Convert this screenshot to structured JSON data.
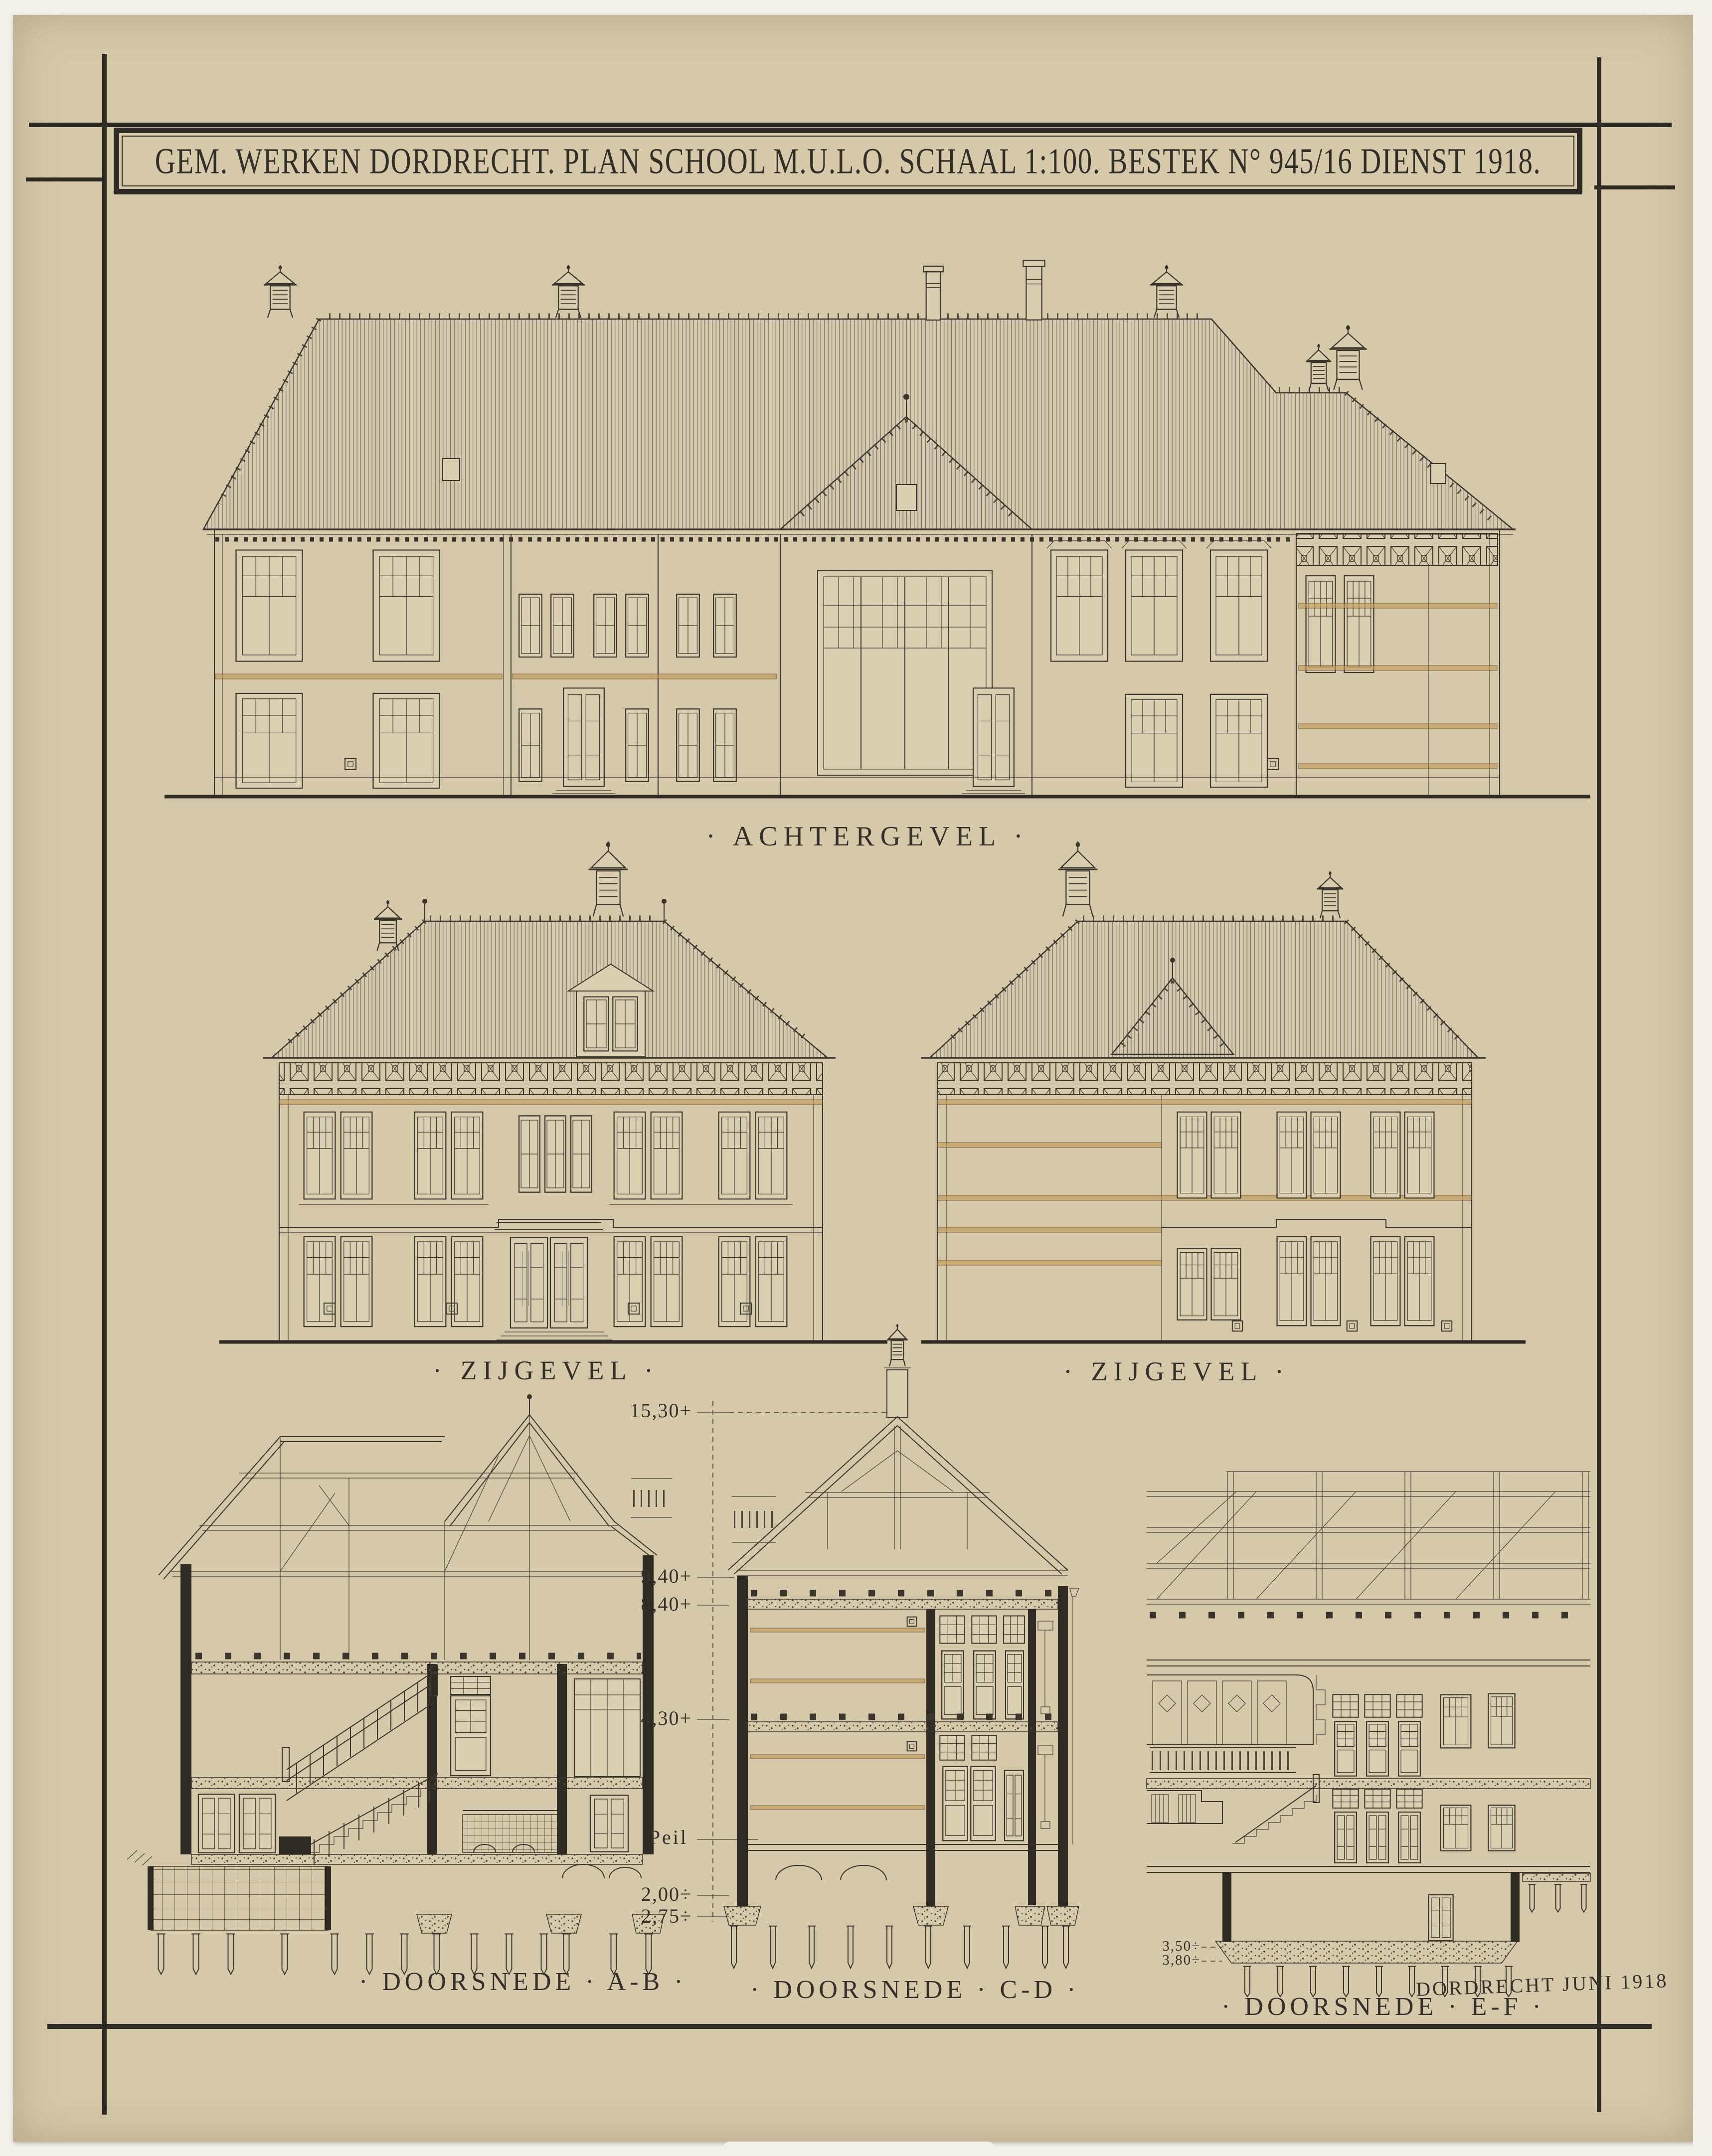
{
  "sheet": {
    "title": "GEM. WERKEN DORDRECHT. PLAN SCHOOL M.U.L.O. SCHAAL 1:100. BESTEK N° 945/16 DIENST 1918.",
    "signature": "DORDRECHT JUNI 1918",
    "labels": {
      "achtergevel": "· ACHTERGEVEL ·",
      "zijgevel_left": "· ZIJGEVEL ·",
      "zijgevel_right": "· ZIJGEVEL ·",
      "doorsnede_ab": "· DOORSNEDE · A-B ·",
      "doorsnede_cd": "· DOORSNEDE · C-D ·",
      "doorsnede_ef": "· DOORSNEDE · E-F ·"
    },
    "dimension_levels": [
      {
        "label": "15,30+",
        "meters": 15.3
      },
      {
        "label": "9,40+",
        "meters": 9.4
      },
      {
        "label": "8,40+",
        "meters": 8.4
      },
      {
        "label": "4,30+",
        "meters": 4.3
      },
      {
        "label": "Peil",
        "meters": 0
      },
      {
        "label": "2,00÷",
        "meters": -2.0
      },
      {
        "label": "2,75÷",
        "meters": -2.75
      }
    ],
    "basement_levels": [
      {
        "label": "3,50÷",
        "meters": -3.5
      },
      {
        "label": "3,80÷",
        "meters": -3.8
      }
    ],
    "colors": {
      "paper": "#d6c9aa",
      "ink": "#3a362d",
      "accent_orange": "#c6984d",
      "accent_blue": "#7e88a0"
    }
  }
}
